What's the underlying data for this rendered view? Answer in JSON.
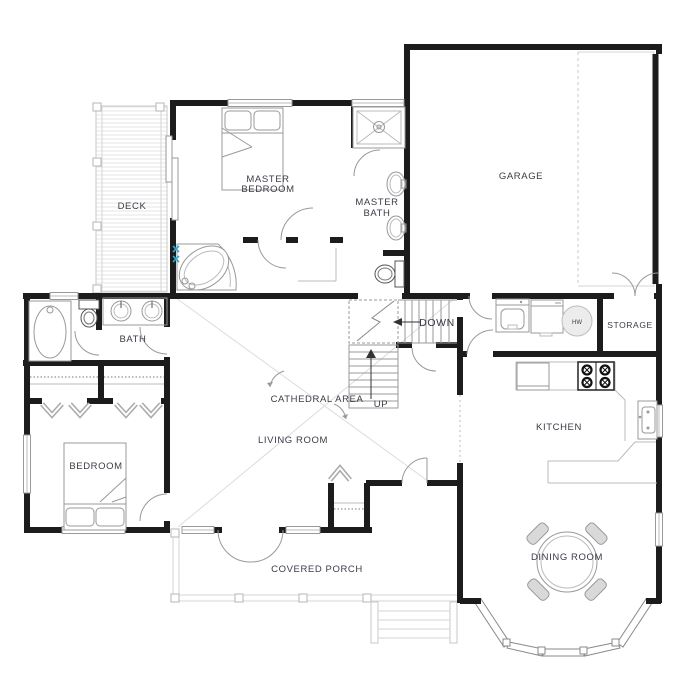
{
  "rooms": {
    "deck": {
      "label": "DECK"
    },
    "master_bedroom": {
      "line1": "MASTER",
      "line2": "BEDROOM"
    },
    "master_bath": {
      "line1": "MASTER",
      "line2": "BATH"
    },
    "garage": {
      "label": "GARAGE"
    },
    "storage": {
      "label": "STORAGE"
    },
    "bath": {
      "label": "BATH"
    },
    "cathedral_area": {
      "label": "CATHEDRAL AREA"
    },
    "living_room": {
      "label": "LIVING ROOM"
    },
    "bedroom": {
      "label": "BEDROOM"
    },
    "kitchen": {
      "label": "KITCHEN"
    },
    "dining_room": {
      "label": "DINING ROOM"
    },
    "covered_porch": {
      "label": "COVERED PORCH"
    }
  },
  "stairs": {
    "down_label": "DOWN",
    "up_label": "UP"
  },
  "equipment": {
    "water_heater_label": "HW"
  },
  "colors": {
    "wall": "#1c1c1c",
    "label_text": "#3b3b47",
    "fixture_line": "#999999",
    "light_line": "#d8d8d8",
    "faucet_accent": "#2aa7c9",
    "background": "#ffffff"
  }
}
